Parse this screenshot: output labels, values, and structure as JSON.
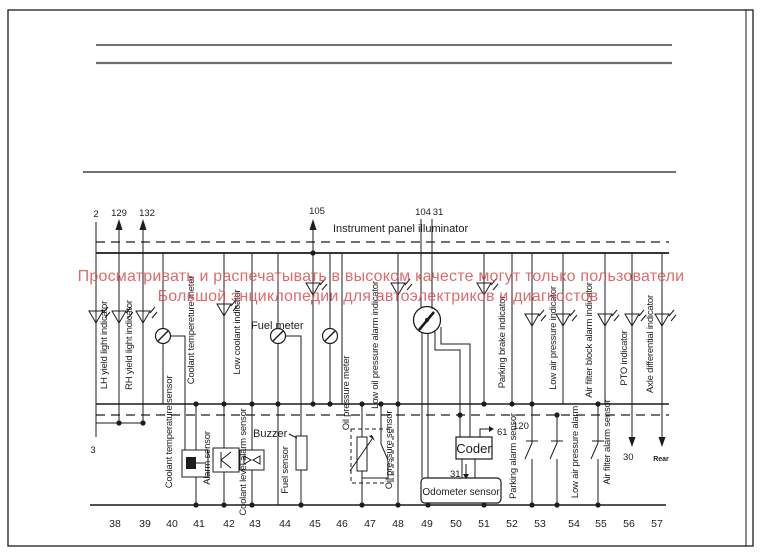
{
  "watermark": {
    "line1": "Просматривать и распечатывать в высоком качесте могут только пользователи",
    "line2": "Большой энциклопедии для автоэлектриков и диагностов",
    "color": "#d85252"
  },
  "title": {
    "instrument_panel": "Instrument panel illuminator"
  },
  "top_terminals": {
    "n2": "2",
    "n129": "129",
    "n132": "132",
    "n105": "105",
    "n104": "104",
    "n31": "31"
  },
  "indicator_labels": {
    "lh": "LH yield light indicator",
    "rh": "RH yield light indicator",
    "coolant_meter": "Coolant tempereture meter",
    "low_coolant": "Low coolant indicator",
    "fuel_meter": "Fuel meter",
    "oil_meter": "Oil pressure meter",
    "low_oil": "Low oil pressure alarm indicator",
    "parking_brake": "Parking brake indicator",
    "low_air": "Low air pressure indicator",
    "air_filter_block": "Air filter block alarm indicator",
    "pto": "PTO indicator",
    "axle_diff": "Axle differential indicator"
  },
  "component_labels": {
    "coolant_temp_sensor": "Coolant temperature sensor",
    "alarm_sensor": "Alarm sensor",
    "coolant_level": "Coolant level alarm sensor",
    "buzzer": "Buzzer",
    "fuel_sensor": "Fuel sensor",
    "oil_sensor": "Oil pressure sensor",
    "coder": "Coder",
    "odometer": "Odometer sensor",
    "parking_alarm": "Parking alarm sensor",
    "low_air_alarm": "Low air pressure alarm",
    "air_filter_alarm": "Air filter alarm sensor"
  },
  "misc_terminals": {
    "n3": "3",
    "n61": "61",
    "n120": "120",
    "n31_coder": "31",
    "n30": "30",
    "rear": "Rear"
  },
  "bottom_terminals": [
    "38",
    "39",
    "40",
    "41",
    "42",
    "43",
    "44",
    "45",
    "46",
    "47",
    "48",
    "49",
    "50",
    "51",
    "52",
    "53",
    "54",
    "55",
    "56",
    "57"
  ]
}
